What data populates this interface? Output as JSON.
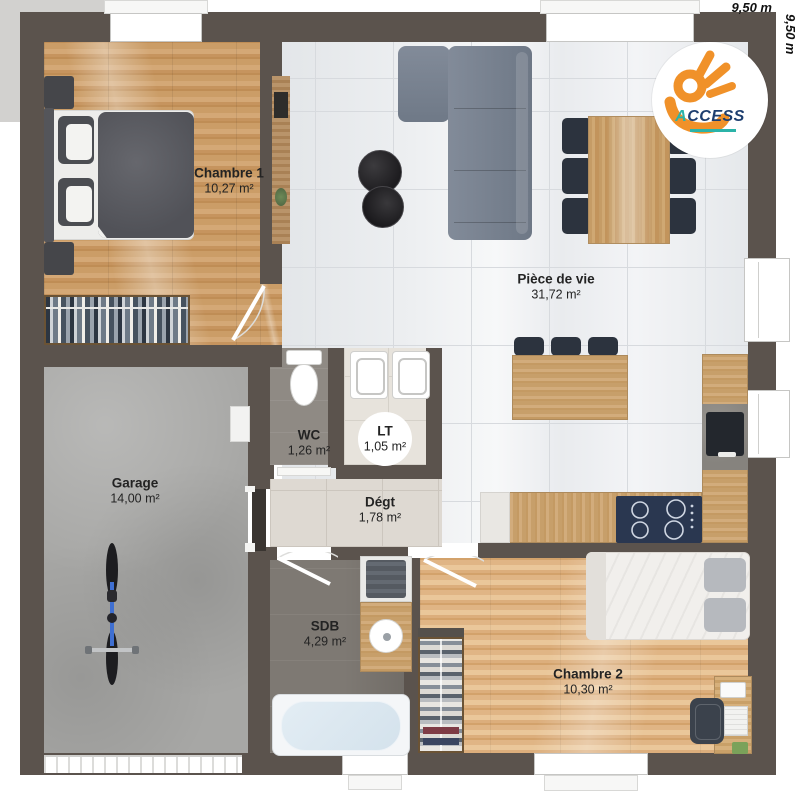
{
  "page": {
    "dimension_top": "9,50 m",
    "dimension_right": "9,50 m"
  },
  "logo": {
    "brand_prefix": "A",
    "brand_suffix": "CCESS"
  },
  "rooms": {
    "chambre1": {
      "name": "Chambre 1",
      "area": "10,27 m²"
    },
    "piece_de_vie": {
      "name": "Pièce de vie",
      "area": "31,72 m²"
    },
    "wc": {
      "name": "WC",
      "area": "1,26 m²"
    },
    "lt": {
      "name": "LT",
      "area": "1,05 m²"
    },
    "degt": {
      "name": "Dégt",
      "area": "1,78 m²"
    },
    "garage": {
      "name": "Garage",
      "area": "14,00 m²"
    },
    "sdb": {
      "name": "SDB",
      "area": "4,29 m²"
    },
    "chambre2": {
      "name": "Chambre 2",
      "area": "10,30 m²"
    }
  }
}
